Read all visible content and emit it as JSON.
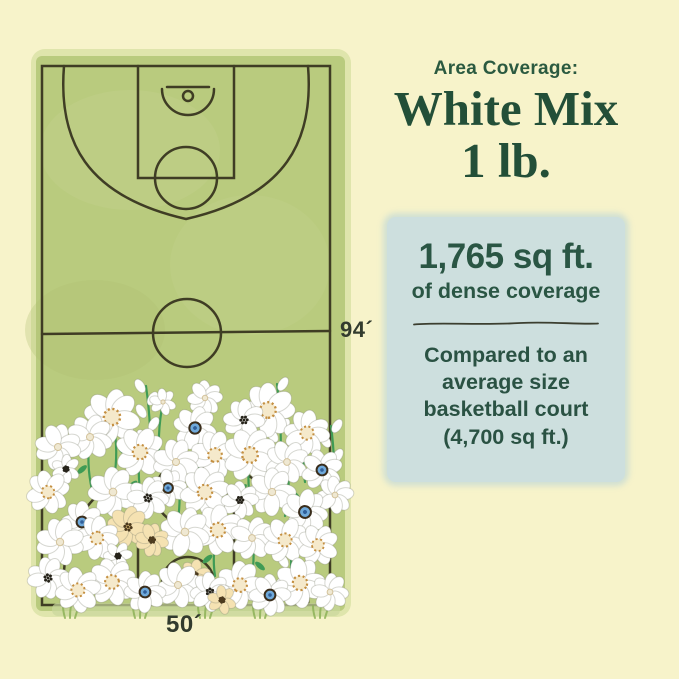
{
  "colors": {
    "background": "#f7f3ca",
    "card_background": "#cddfde",
    "text_green": "#2a5644",
    "title_green": "#234f38",
    "court_green": "#b9cb7e",
    "court_line": "#35311d",
    "flower_blue_center": "#6fa9da",
    "flower_gold_center": "#c48f41",
    "stem_green": "#3f9b55"
  },
  "headline": {
    "kicker": "Area Coverage:",
    "title_line1": "White Mix",
    "title_line2": "1 lb."
  },
  "coverage_card": {
    "area": "1,765 sq ft.",
    "area_caption": "of dense coverage",
    "comparison_lines": [
      "Compared to an",
      "average size",
      "basketball court",
      "(4,700 sq ft.)"
    ]
  },
  "court": {
    "length_label": "94´",
    "width_label": "50´"
  },
  "illustration": {
    "flowers": [
      [
        112,
        417,
        27,
        "g"
      ],
      [
        163,
        402,
        13,
        "w"
      ],
      [
        205,
        398,
        17,
        "w"
      ],
      [
        244,
        420,
        20,
        "d"
      ],
      [
        268,
        410,
        26,
        "g"
      ],
      [
        307,
        433,
        22,
        "g"
      ],
      [
        195,
        428,
        21,
        "b"
      ],
      [
        58,
        447,
        22,
        "w"
      ],
      [
        90,
        437,
        22,
        "w"
      ],
      [
        140,
        452,
        24,
        "g"
      ],
      [
        176,
        462,
        22,
        "w"
      ],
      [
        215,
        455,
        23,
        "g"
      ],
      [
        250,
        455,
        26,
        "g"
      ],
      [
        287,
        462,
        21,
        "w"
      ],
      [
        66,
        469,
        14,
        "d"
      ],
      [
        322,
        470,
        20,
        "b"
      ],
      [
        48,
        492,
        21,
        "g"
      ],
      [
        82,
        522,
        20,
        "b"
      ],
      [
        113,
        492,
        24,
        "w"
      ],
      [
        148,
        498,
        20,
        "d"
      ],
      [
        168,
        488,
        18,
        "b"
      ],
      [
        205,
        492,
        24,
        "g"
      ],
      [
        240,
        500,
        18,
        "d"
      ],
      [
        272,
        492,
        23,
        "w"
      ],
      [
        305,
        512,
        22,
        "b"
      ],
      [
        335,
        495,
        18,
        "w"
      ],
      [
        60,
        542,
        23,
        "w"
      ],
      [
        97,
        538,
        21,
        "g"
      ],
      [
        128,
        527,
        20,
        "p"
      ],
      [
        152,
        540,
        16,
        "p"
      ],
      [
        185,
        532,
        24,
        "w"
      ],
      [
        218,
        530,
        24,
        "g"
      ],
      [
        252,
        538,
        21,
        "w"
      ],
      [
        285,
        540,
        22,
        "g"
      ],
      [
        318,
        545,
        20,
        "g"
      ],
      [
        118,
        556,
        14,
        "d"
      ],
      [
        48,
        578,
        20,
        "d"
      ],
      [
        78,
        590,
        22,
        "g"
      ],
      [
        112,
        582,
        23,
        "g"
      ],
      [
        145,
        592,
        20,
        "b"
      ],
      [
        178,
        585,
        22,
        "w"
      ],
      [
        210,
        592,
        19,
        "d"
      ],
      [
        240,
        585,
        23,
        "g"
      ],
      [
        270,
        595,
        20,
        "b"
      ],
      [
        300,
        583,
        24,
        "g"
      ],
      [
        330,
        592,
        18,
        "w"
      ],
      [
        195,
        575,
        15,
        "p"
      ],
      [
        222,
        600,
        14,
        "p"
      ]
    ],
    "stems": [
      [
        163,
        402,
        160,
        468
      ],
      [
        205,
        398,
        207,
        462
      ],
      [
        244,
        420,
        240,
        472
      ],
      [
        195,
        428,
        197,
        490
      ],
      [
        268,
        410,
        265,
        462
      ],
      [
        112,
        417,
        115,
        472
      ],
      [
        307,
        433,
        305,
        482
      ],
      [
        176,
        462,
        178,
        520
      ],
      [
        250,
        455,
        252,
        510
      ],
      [
        322,
        470,
        320,
        525
      ],
      [
        140,
        452,
        143,
        506
      ],
      [
        287,
        462,
        285,
        516
      ],
      [
        218,
        530,
        215,
        576
      ],
      [
        252,
        538,
        250,
        582
      ],
      [
        90,
        437,
        92,
        490
      ]
    ],
    "sprigs": [
      [
        150,
        470,
        146,
        386,
        5
      ],
      [
        280,
        470,
        277,
        384,
        6
      ],
      [
        333,
        500,
        331,
        426,
        4
      ],
      [
        290,
        576,
        288,
        538,
        3
      ]
    ],
    "grass_x": [
      70,
      140,
      205,
      260,
      320
    ]
  }
}
